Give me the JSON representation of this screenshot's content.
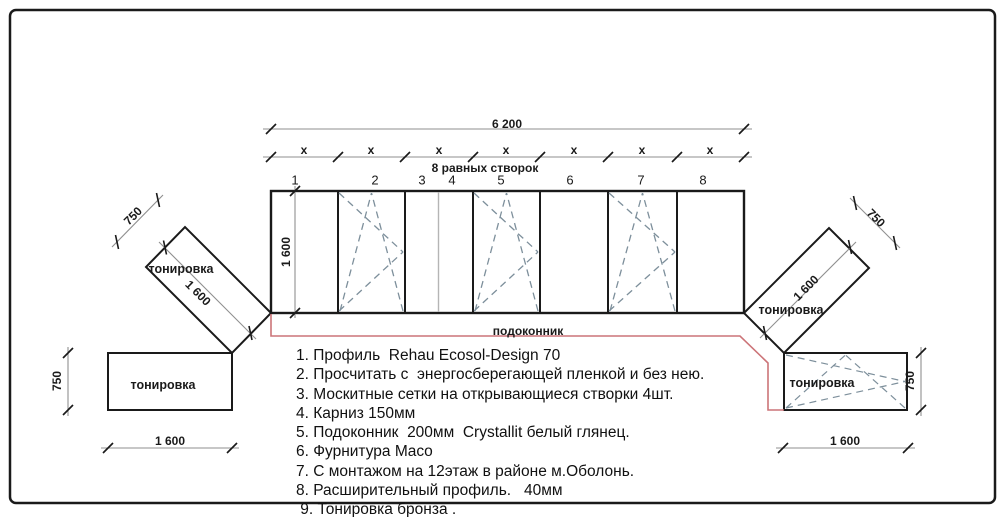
{
  "drawing": {
    "dims": {
      "total_width": "6 200",
      "equal_sashes_note": "8 равных створок",
      "window_height": "1 600",
      "wing_length": "1 600",
      "wing_depth": "750",
      "lower_width": "1 600",
      "lower_height": "750"
    },
    "x_labels": [
      "x",
      "x",
      "x",
      "x",
      "x",
      "x",
      "x"
    ],
    "sash_numbers": [
      "1",
      "2",
      "3",
      "4",
      "5",
      "6",
      "7",
      "8"
    ],
    "labels": {
      "tint": "тонировка",
      "sill": "подоконник"
    },
    "notes": [
      "1. Профиль  Rehau Ecosol-Design 70",
      "2. Просчитать с  энергосберегающей пленкой и без нею.",
      "3. Москитные сетки на открывающиеся створки 4шт.",
      "4. Карниз 150мм",
      "5. Подоконник  200мм  Crystallit белый глянец.",
      "6. Фурнитура Maco",
      "7. С монтажом на 12этаж в районе м.Оболонь.",
      "8. Расширительный профиль.   40мм",
      " 9. Тонировка бронза ."
    ],
    "colors": {
      "line": "#1a1a1a",
      "dim_line": "#8f8f8f",
      "sash_dash": "#7d8f9b",
      "sill_red": "#cc7478",
      "thin_mullion": "#b5b5b5"
    }
  }
}
